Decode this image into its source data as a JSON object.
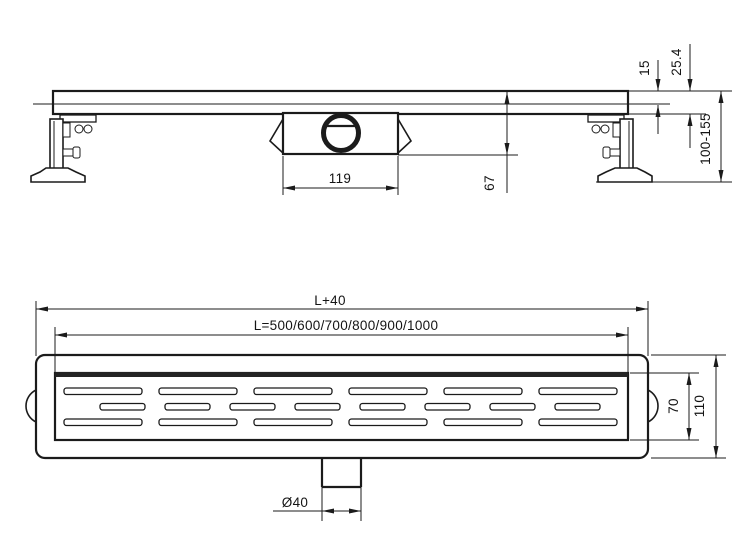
{
  "drawing": {
    "type": "technical-drawing",
    "subject": "linear shower drain channel",
    "background": "#ffffff",
    "line_color": "#1b1b1b",
    "views": {
      "side": {
        "label": "side elevation",
        "dims": {
          "grate_height": "15",
          "edge_height": "25.4",
          "adjust_range": "100-155",
          "trap_length": "119",
          "trap_depth": "67"
        }
      },
      "plan": {
        "label": "top plan",
        "dims": {
          "overall_length": "L+40",
          "length_options": "L=500/600/700/800/900/1000",
          "grate_width": "70",
          "body_width": "110",
          "outlet_diameter": "Ø40"
        }
      }
    }
  }
}
